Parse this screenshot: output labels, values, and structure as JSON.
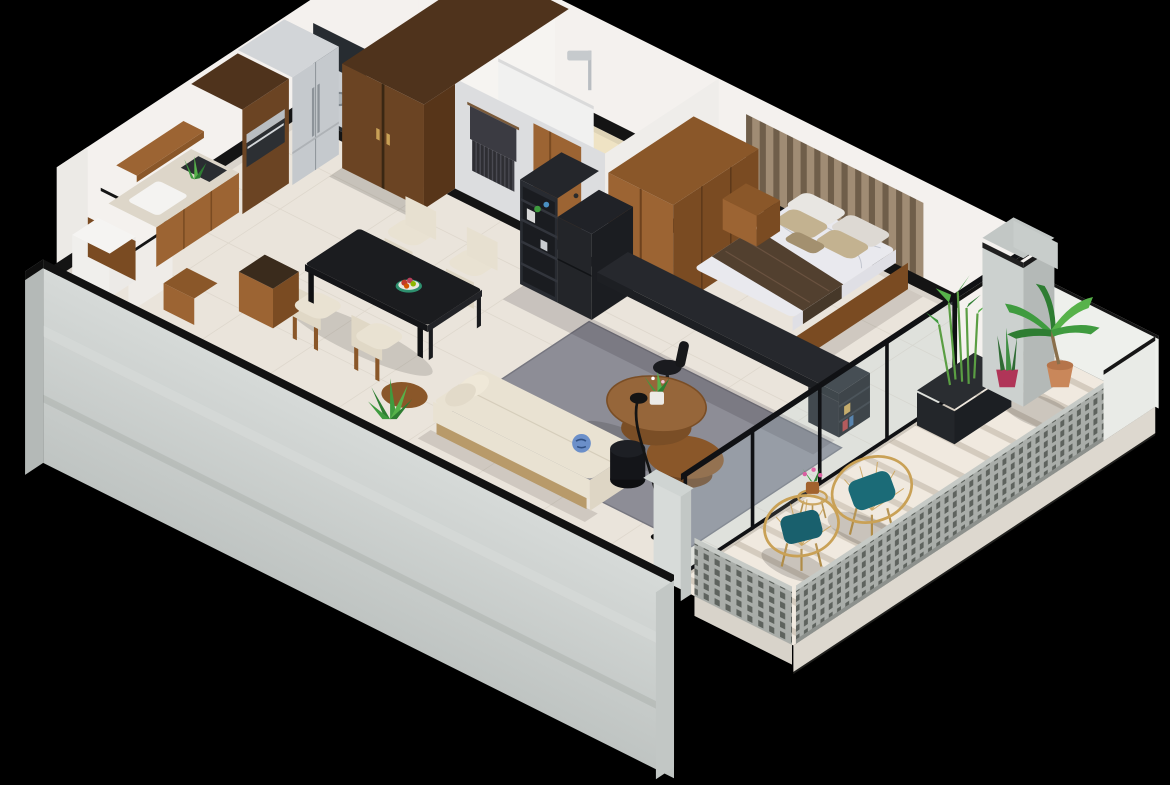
{
  "scene": {
    "title": "Isometric 3D cutaway floor plan of a one-bedroom apartment with balcony",
    "description": "Photoreal-style isometric render of a one-bedroom apartment: kitchen and dining along the upper-left wall, living room with sofa and round coffee tables in the center, bathroom and wardrobes at the top, bedroom with double bed on the right, and a long balcony with perforated railing, two acapulco chairs and potted plants along the lower-right edge.",
    "view": "axonometric cutaway, black background"
  },
  "palette": {
    "bg": "#000000",
    "wall": "#f4f1ee",
    "wall-shade": "#eceae6",
    "art-wall": "#dcdddf",
    "floor": "#eae4db",
    "balcony-floor": "#f0e9df",
    "tile-cream": "#efe3c4",
    "line-black": "#141414",
    "furn-black": "#24262b",
    "wood-mid": "#9c6433",
    "wood-mid-top": "#8a5729",
    "wood-mid-dark": "#7a4b22",
    "wood-dark": "#6b4423",
    "wood-dark-deep": "#573519",
    "steel": "#c5c9cd",
    "rug": "#8d8d96",
    "sofa": "#e9e2d2",
    "duvet": "#e9e9ee",
    "throw": "#52402f",
    "khaki": "#c3b290",
    "teal": "#1b6b77",
    "gold": "#c9a156",
    "green": "#3f9b3f",
    "green-dark": "#2e7d32",
    "green-light": "#57b24a",
    "concrete": "#ccd1cf",
    "concrete-dark": "#b4b9b7",
    "terracotta": "#c9875a",
    "magenta-pot": "#b03558"
  },
  "rooms": [
    {
      "name": "kitchen",
      "furniture": [
        "wooden base cabinets with stone countertop",
        "inset white sink",
        "floating wooden shelf",
        "tall oven housing column",
        "stainless french-door refrigerator",
        "counter plant",
        "wooden bench",
        "utility alcove with white cabinet"
      ]
    },
    {
      "name": "dining",
      "furniture": [
        "black rectangular dining table",
        "four cream barrel chairs",
        "fruit bowl",
        "open wooden crate"
      ]
    },
    {
      "name": "living-room",
      "furniture": [
        "cream fabric sofa with bolster cushions",
        "decorative blue plate",
        "two round wooden nesting coffee tables",
        "black cylinder stool",
        "arc floor lamp",
        "gray area rug",
        "floor plant",
        "round wooden side table"
      ]
    },
    {
      "name": "bathroom",
      "furniture": [
        "walk-in shower with rain head",
        "low partition",
        "toilet",
        "white vanity",
        "wooden door",
        "macrame wall hanging on gray wall"
      ]
    },
    {
      "name": "laundry-closet",
      "furniture": [
        "washing machine"
      ]
    },
    {
      "name": "hallway",
      "furniture": [
        "tall dark wooden wardrobe"
      ]
    },
    {
      "name": "bedroom",
      "furniture": [
        "double bed on wooden platform",
        "marble-pattern duvet",
        "brown throw blanket",
        "khaki and white pillows",
        "wood-slat headboard wall",
        "sliding-door wooden wardrobe",
        "floating nightstand",
        "black shelving unit with long desk",
        "desk chair"
      ]
    },
    {
      "name": "balcony",
      "furniture": [
        "striped shadow tile floor",
        "perforated metal railing",
        "two gold acapulco chairs with teal cushions",
        "gold wire side table with flowering plant",
        "bamboo planter box",
        "palm in terracotta pot",
        "snake plant in magenta pot",
        "concrete pillar and beam",
        "black-framed sliding glass doors"
      ]
    }
  ]
}
